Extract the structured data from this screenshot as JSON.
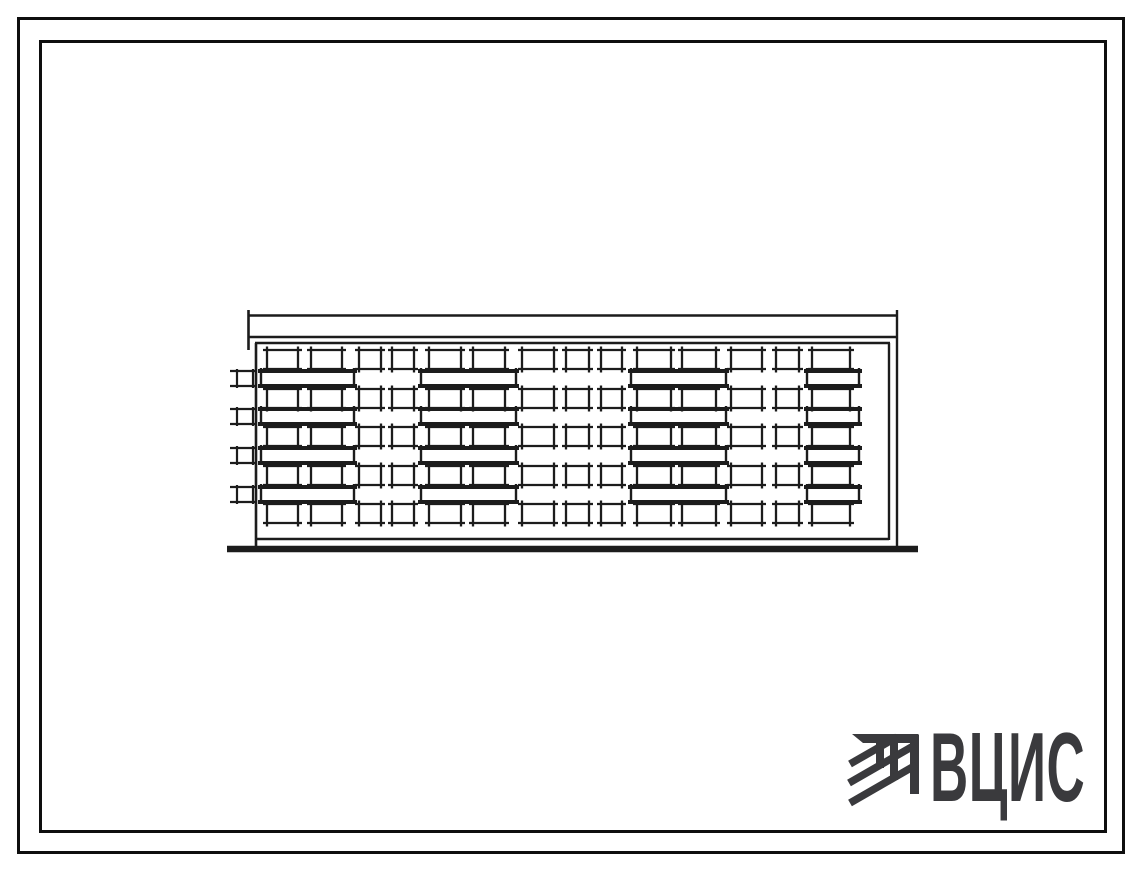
{
  "page": {
    "background": "#ffffff",
    "frame_color": "#0e0e0e",
    "ink_color": "#1c1c1c"
  },
  "frames": {
    "outer": {
      "x": 17,
      "y": 17,
      "w": 1108,
      "h": 837,
      "stroke": 3
    },
    "inner": {
      "x": 39,
      "y": 40,
      "w": 1068,
      "h": 793,
      "stroke": 3
    }
  },
  "drawing": {
    "description": "hand-drawn front elevation of a five-storey apartment block",
    "ink": "#1c1c1c",
    "floors": 5,
    "windows_per_floor": 14,
    "balconies_per_floor": 4,
    "roof": {
      "x1": 248,
      "x2": 898,
      "top_y": 315.5,
      "band_bottom_y": 337,
      "facade_top_y": 343,
      "left_tick_x": 248.5,
      "right_tick_x": 897,
      "tick_top_y": 310,
      "left_tick_bottom_y": 350,
      "right_tick_bottom_y": 546
    },
    "facade": {
      "left_x": 256,
      "right_x": 889,
      "top_y": 343,
      "bottom_y": 539,
      "wall_bottom_y": 546
    },
    "ground": {
      "x1": 227,
      "x2": 918,
      "y": 549,
      "thickness": 6.5
    },
    "window_rows_y": [
      350,
      389,
      427,
      466,
      504
    ],
    "window_height": 19,
    "columns": [
      {
        "x": 267,
        "w": 31
      },
      {
        "x": 311,
        "w": 31
      },
      {
        "x": 359,
        "w": 22
      },
      {
        "x": 392,
        "w": 22
      },
      {
        "x": 429,
        "w": 32
      },
      {
        "x": 473,
        "w": 32
      },
      {
        "x": 522,
        "w": 32
      },
      {
        "x": 566,
        "w": 23
      },
      {
        "x": 601,
        "w": 21
      },
      {
        "x": 637,
        "w": 34
      },
      {
        "x": 682,
        "w": 34
      },
      {
        "x": 731,
        "w": 31
      },
      {
        "x": 776,
        "w": 23
      },
      {
        "x": 812,
        "w": 38
      }
    ],
    "balcony_rows_y": [
      371,
      409,
      448,
      487
    ],
    "balcony_height": 15,
    "balconies": [
      {
        "x": 261,
        "w": 93
      },
      {
        "x": 421,
        "w": 95
      },
      {
        "x": 631,
        "w": 95
      },
      {
        "x": 807,
        "w": 52
      }
    ],
    "side_balcony": {
      "x": 237,
      "w": 16,
      "tick_x1": 230,
      "tick_x2": 256
    }
  },
  "logo": {
    "text": "ВЦИС",
    "color": "#3a3a3d",
    "icon": "hatched-beam-emblem"
  }
}
